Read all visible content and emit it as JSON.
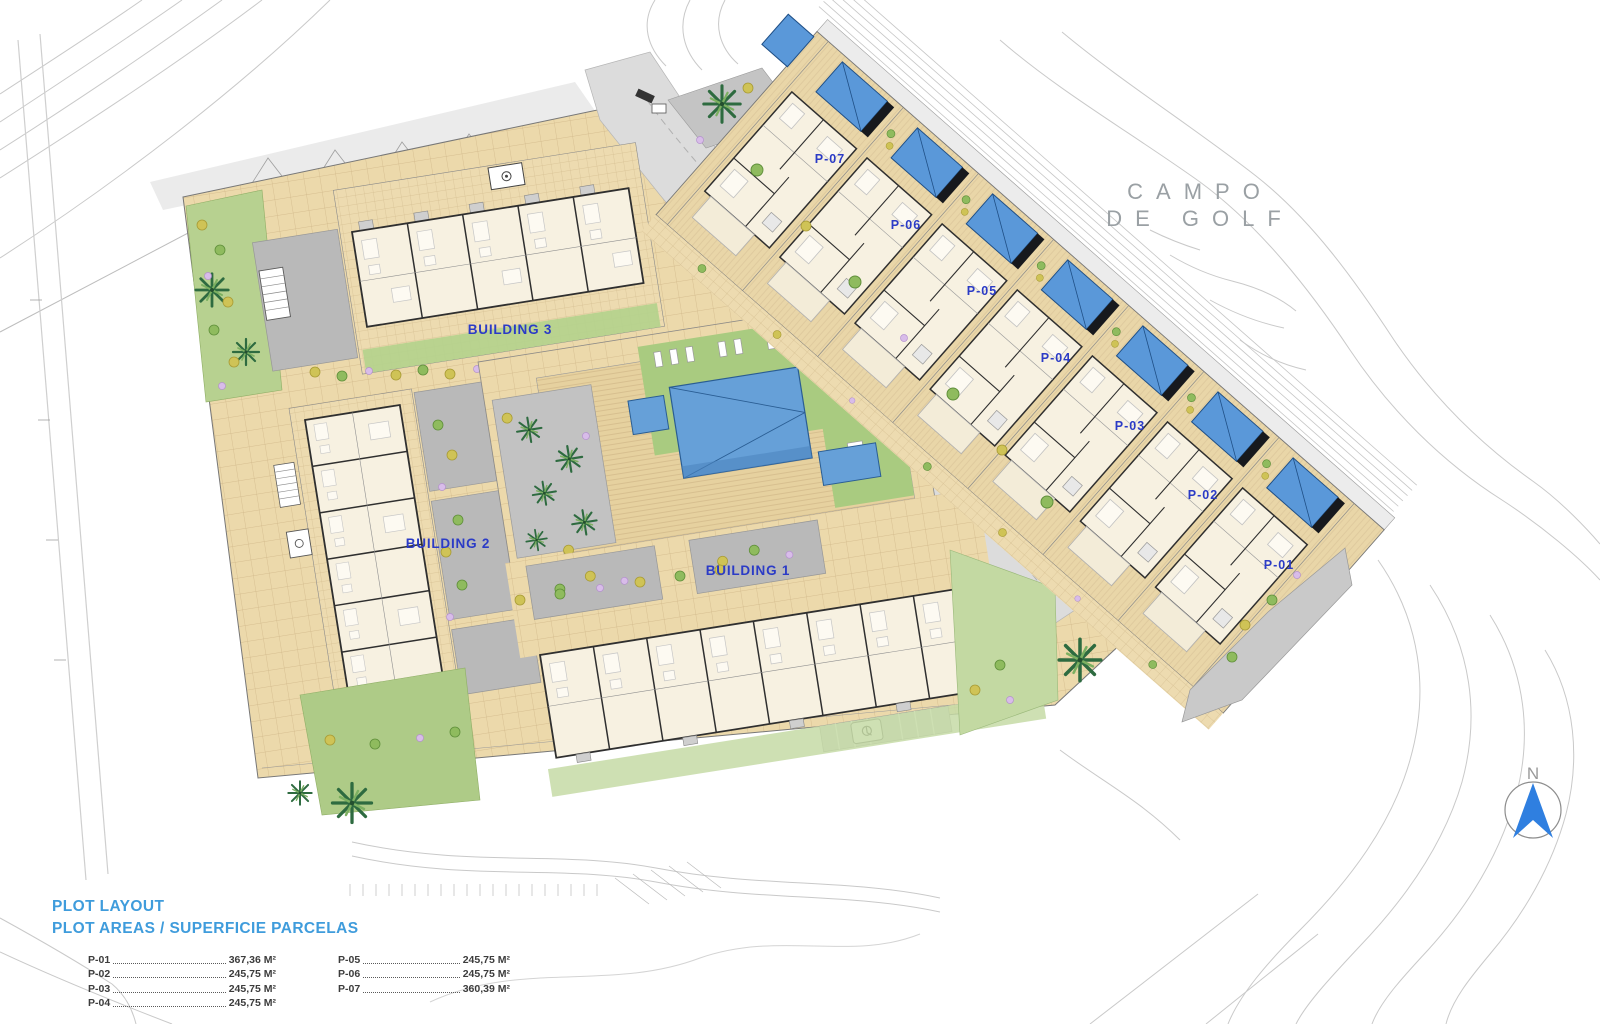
{
  "plan": {
    "buildings": [
      {
        "label": "BUILDING 1"
      },
      {
        "label": "BUILDING 2"
      },
      {
        "label": "BUILDING 3"
      }
    ],
    "plots": [
      {
        "label": "P-01"
      },
      {
        "label": "P-02"
      },
      {
        "label": "P-03"
      },
      {
        "label": "P-04"
      },
      {
        "label": "P-05"
      },
      {
        "label": "P-06"
      },
      {
        "label": "P-07"
      }
    ],
    "golf_label": {
      "line1": "CAMPO",
      "line2": "DE GOLF"
    },
    "north_label": "N"
  },
  "legend": {
    "title": "PLOT LAYOUT",
    "subtitle": "PLOT AREAS / SUPERFICIE PARCELAS",
    "entries": [
      {
        "plot": "P-01",
        "area": "367,36 M²"
      },
      {
        "plot": "P-02",
        "area": "245,75 M²"
      },
      {
        "plot": "P-03",
        "area": "245,75 M²"
      },
      {
        "plot": "P-04",
        "area": "245,75 M²"
      },
      {
        "plot": "P-05",
        "area": "245,75 M²"
      },
      {
        "plot": "P-06",
        "area": "245,75 M²"
      },
      {
        "plot": "P-07",
        "area": "360,39 M²"
      }
    ]
  },
  "colors": {
    "label_blue": "#2b3bc6",
    "legend_blue": "#3f9cdc",
    "pool_blue": "#5a98d9",
    "paving_tan": "#ecd9ab",
    "lawn_green": "#a9cb80",
    "contour_gray": "#c9c9c9"
  }
}
